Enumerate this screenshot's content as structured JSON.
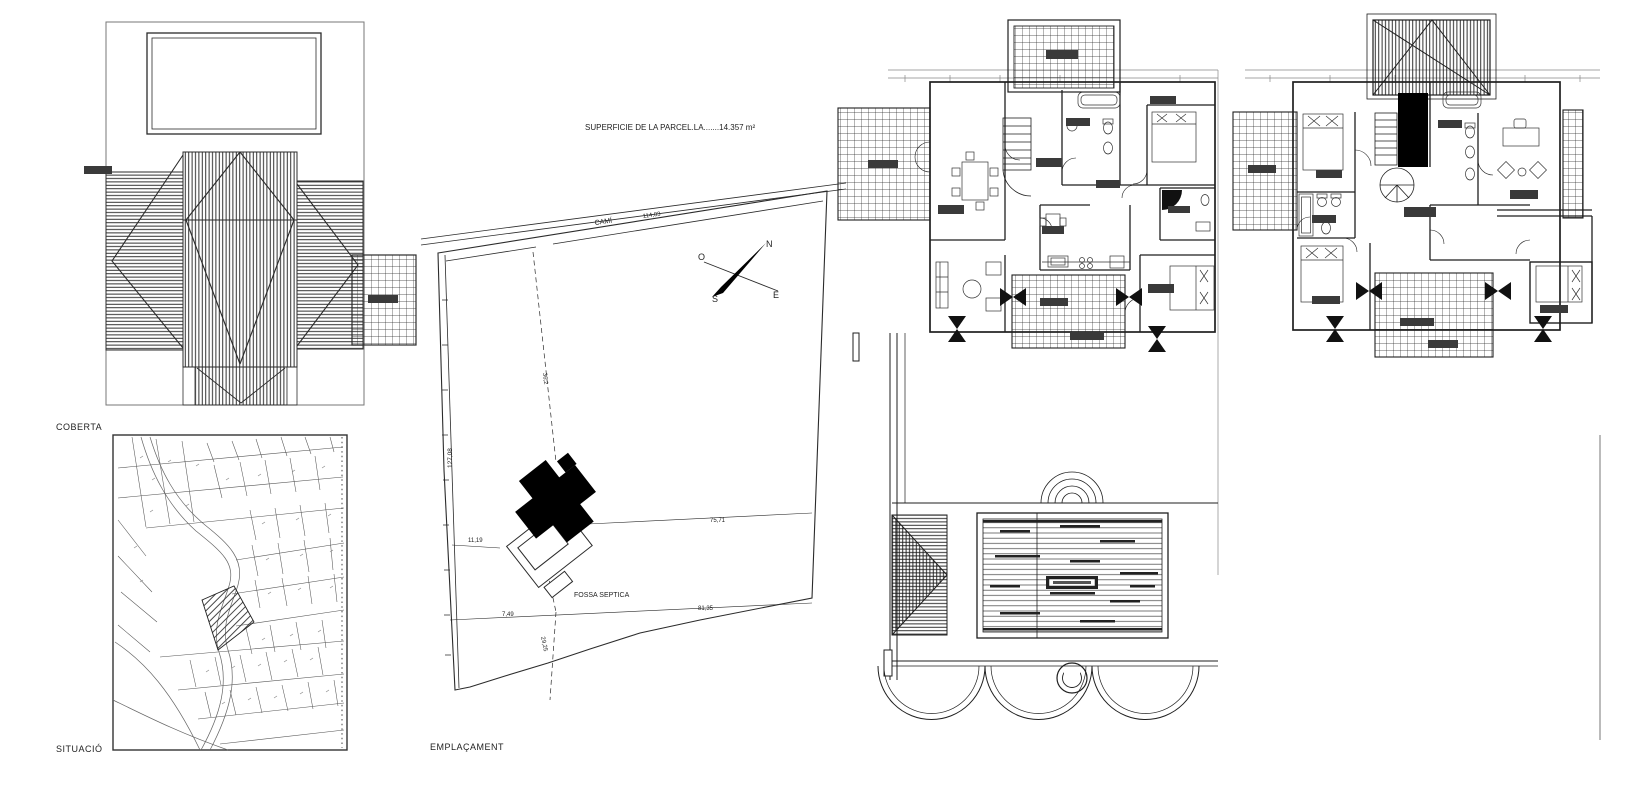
{
  "page": {
    "paper_color": "#ffffff",
    "ink_color": "#1f1f1f"
  },
  "panels": {
    "roof_plan": {
      "label": "COBERTA"
    },
    "situation_map": {
      "label": "SITUACIÓ"
    },
    "site_plan": {
      "label": "EMPLAÇAMENT",
      "surface_note": "SUPERFICIE DE LA PARCEL.LA.......14.357 m²",
      "road_label": "CAMÍ",
      "septic_tank_label": "FOSSA SEPTICA",
      "dimensions": {
        "road_length": "114,03",
        "west_edge": "127,08",
        "house_offset": "11,19",
        "septic_offset": "7,49",
        "upper_cross": "75,71",
        "lower_cross": "81,35",
        "axis_length": "36,2",
        "south_offset": "29,25"
      },
      "compass": {
        "north": "N",
        "south": "S",
        "east": "E",
        "west": "O"
      }
    }
  }
}
